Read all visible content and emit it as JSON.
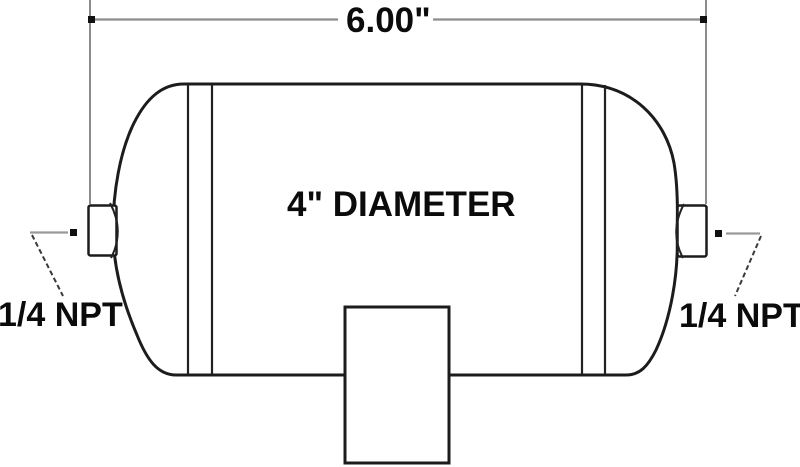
{
  "drawing": {
    "type": "technical-dimension-diagram",
    "subject": "air-tank-side-view",
    "width_dimension": "6.00\"",
    "diameter_label": "4\" DIAMETER",
    "left_port_label": "1/4 NPT",
    "right_port_label": "1/4 NPT",
    "colors": {
      "outline": "#1c1c1c",
      "dimension_lines": "#8c8c8c",
      "leader_lines": "#3a3a3a",
      "text": "#0b0b0b",
      "background": "#ffffff"
    }
  }
}
